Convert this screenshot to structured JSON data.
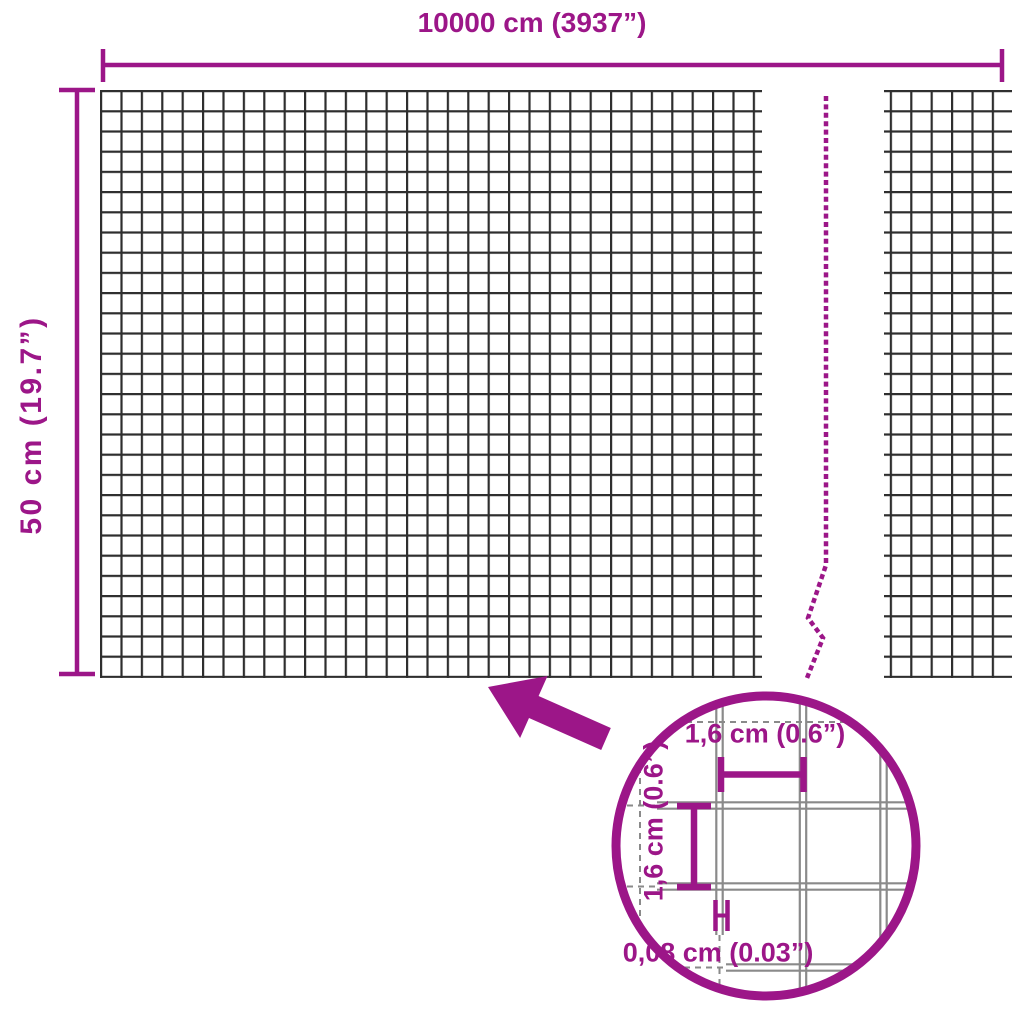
{
  "diagram_title": "wire mesh panel dimension diagram",
  "dimensions": {
    "width_label": "10000 cm (3937”)",
    "height_label": "50 cm (19.7”)"
  },
  "detail": {
    "cell_width_label": "1,6 cm (0.6”)",
    "cell_height_label": "1,6 cm (0.6”)",
    "wire_thickness_label": "0,08 cm (0.03”)"
  },
  "colors": {
    "accent": "#9C1688",
    "mesh_wire": "#2E2E2E",
    "detail_wire": "#8A8A8A",
    "background": "#FFFFFF"
  }
}
